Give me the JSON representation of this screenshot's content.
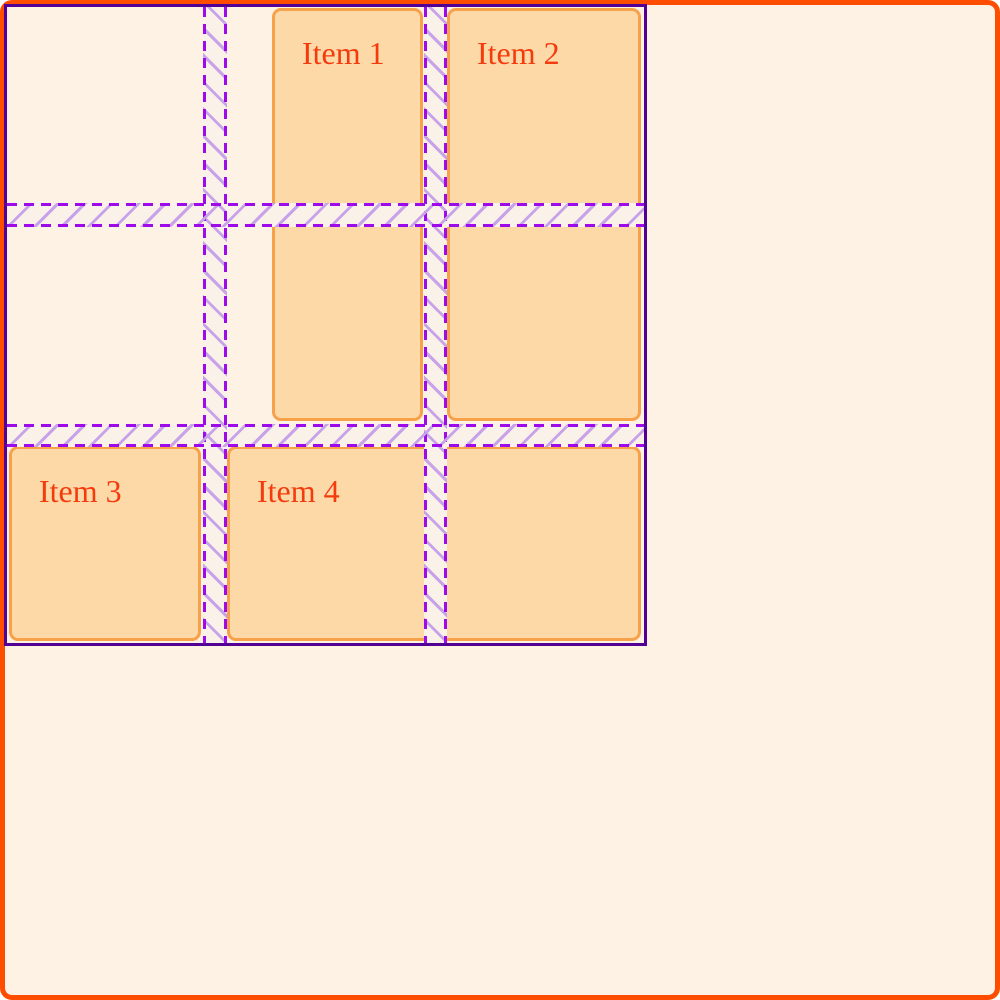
{
  "grid_overlay": {
    "items": [
      {
        "label": "Item 1"
      },
      {
        "label": "Item 2"
      },
      {
        "label": "Item 3"
      },
      {
        "label": "Item 4"
      }
    ],
    "structure": {
      "columns": 3,
      "rows": 3,
      "gap_px": 24
    }
  },
  "colors": {
    "frame": "#FF4D00",
    "bg": "#FDF2E4",
    "itemFill": "#FDD9A7",
    "itemBorder": "#F7A14B",
    "itemText": "#F43B0E",
    "gridBorder": "#530195",
    "line": "#9E0BEB",
    "hatch": "#C8A3E9",
    "gapFill": "#FAF1E9"
  }
}
